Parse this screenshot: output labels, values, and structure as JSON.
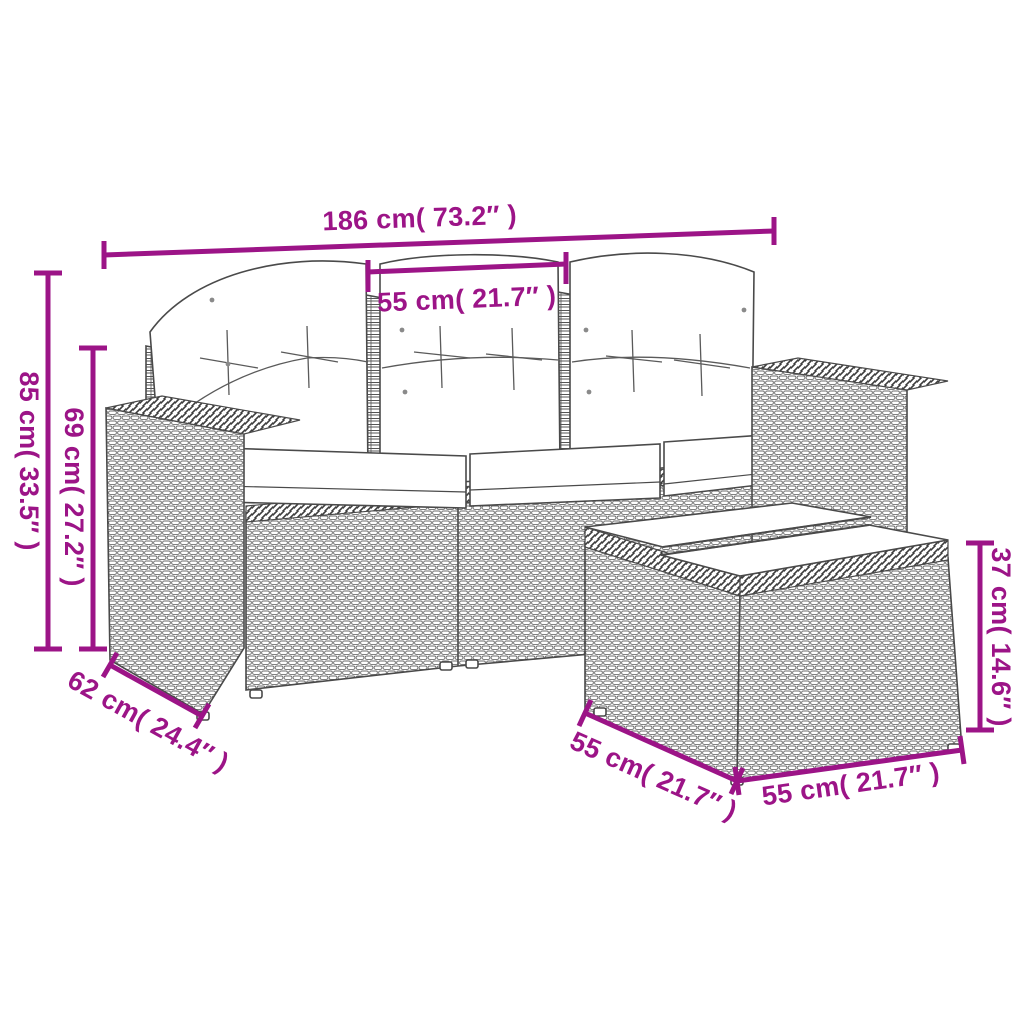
{
  "accent_color": "#9c1487",
  "artwork_line_color": "#4a4a4a",
  "dimensions": {
    "sofa_width": "186 cm( 73.2″ )",
    "seat_width": "55 cm( 21.7″ )",
    "sofa_height": "85 cm( 33.5″ )",
    "backrest_height": "69 cm( 27.2″ )",
    "sofa_depth": "62 cm( 24.4″ )",
    "table_depth": "55 cm( 21.7″ )",
    "table_width": "55 cm( 21.7″ )",
    "table_height": "37 cm( 14.6″ )"
  }
}
